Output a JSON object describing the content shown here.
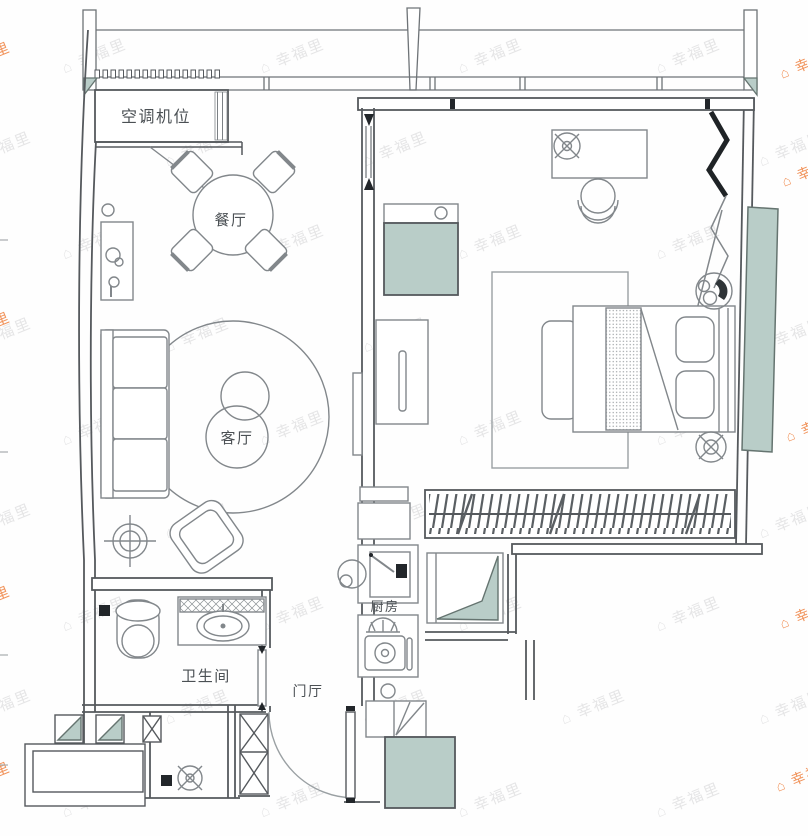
{
  "rooms": {
    "ac": "空调机位",
    "dining": "餐厅",
    "living": "客厅",
    "bath": "卫生间",
    "foyer": "门厅",
    "kitchen": "厨房"
  },
  "watermark": {
    "text": "幸福里",
    "house_icon": "⌂"
  },
  "colors": {
    "wall_line": "#55595d",
    "furniture_line": "#82878b",
    "light_line": "#a7acaf",
    "accent_black": "#22262a",
    "teal_fill": "#b9cdc8",
    "teal_stroke": "#657470",
    "label_text": "#4b5054",
    "watermark_gray": "#8c8f91",
    "watermark_orange": "#ee7f3c"
  }
}
